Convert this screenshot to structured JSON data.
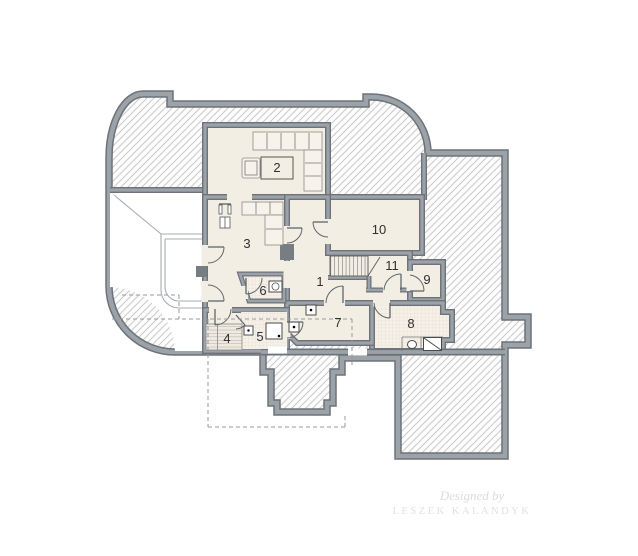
{
  "floor_plan": {
    "room_labels": {
      "r1": "1",
      "r2": "2",
      "r3": "3",
      "r4": "4",
      "r5": "5",
      "r6": "6",
      "r7": "7",
      "r8": "8",
      "r9": "9",
      "r10": "10",
      "r11": "11"
    },
    "watermark": {
      "designed_by": "Designed by",
      "author": "LESZEK KALANDYK"
    },
    "colors": {
      "wall_fill": "#9ba2a8",
      "wall_edge": "#6d7378",
      "floor": "#f3eee4",
      "hatch_line": "#cbcbcb",
      "tile_line": "#ddd5c7"
    }
  }
}
